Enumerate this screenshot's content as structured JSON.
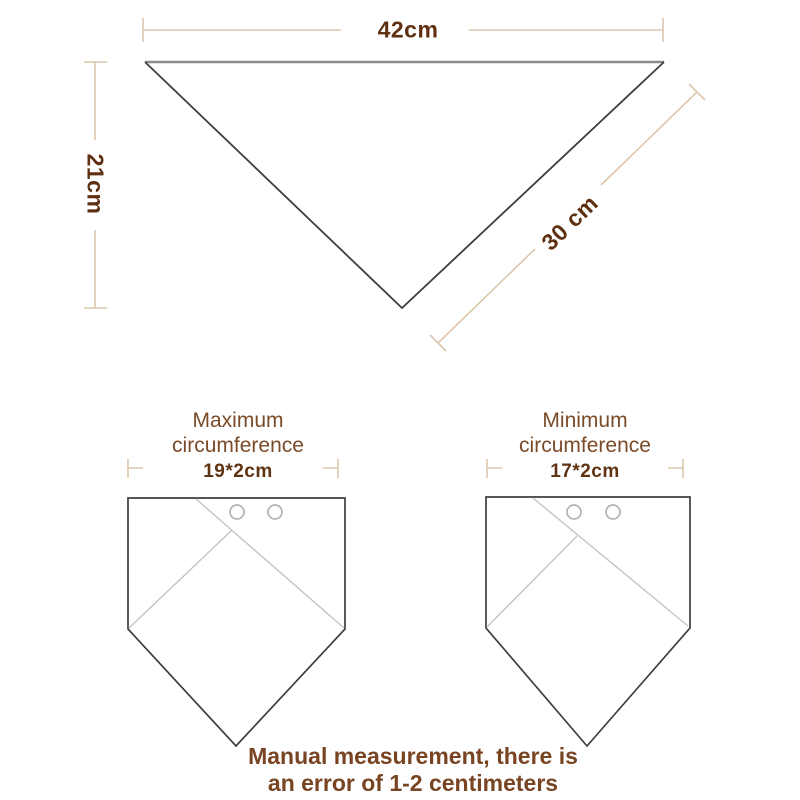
{
  "colors": {
    "dimension_line": "#dcc6ad",
    "measure_text": "#5e2f10",
    "caption_text": "#7b4b28",
    "caption_value_text": "#5f3312",
    "note_text": "#784422",
    "scarf_top_edge": "#8a8a8a",
    "scarf_outline": "#3e3e3e",
    "fold_line": "#c6c4c2",
    "snap_circle": "#b4b2b0",
    "background": "#ffffff"
  },
  "triangle": {
    "width_label": "42cm",
    "height_label": "21cm",
    "side_label": "30 cm"
  },
  "bandanas": [
    {
      "title_line1": "Maximum",
      "title_line2": "circumference",
      "value": "19*2cm"
    },
    {
      "title_line1": "Minimum",
      "title_line2": "circumference",
      "value": "17*2cm"
    }
  ],
  "note": {
    "line1": "Manual measurement, there is",
    "line2": "an error of 1-2 centimeters"
  }
}
